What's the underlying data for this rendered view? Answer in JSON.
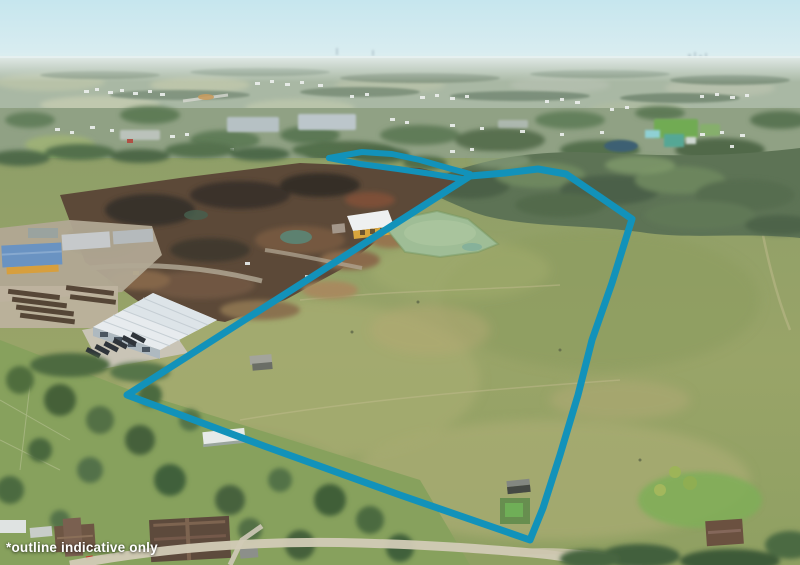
{
  "annotation": {
    "disclaimer": "*outline indicative only"
  },
  "overlay": {
    "color": "#1292ba",
    "boundary_stroke_width": 7,
    "tail_stroke_width": 6,
    "boundary_points": [
      [
        470,
        176
      ],
      [
        505,
        173
      ],
      [
        538,
        169
      ],
      [
        566,
        174
      ],
      [
        600,
        197
      ],
      [
        632,
        219
      ],
      [
        612,
        283
      ],
      [
        592,
        340
      ],
      [
        578,
        395
      ],
      [
        560,
        455
      ],
      [
        543,
        508
      ],
      [
        530,
        540
      ],
      [
        400,
        495
      ],
      [
        264,
        446
      ],
      [
        127,
        395
      ]
    ],
    "tail_top_points": [
      [
        470,
        174
      ],
      [
        448,
        168
      ],
      [
        420,
        160
      ],
      [
        392,
        154
      ],
      [
        362,
        152
      ],
      [
        329,
        158
      ]
    ],
    "tail_bottom_points": [
      [
        329,
        158
      ],
      [
        360,
        164
      ],
      [
        398,
        169
      ],
      [
        432,
        174
      ],
      [
        462,
        179
      ]
    ]
  }
}
